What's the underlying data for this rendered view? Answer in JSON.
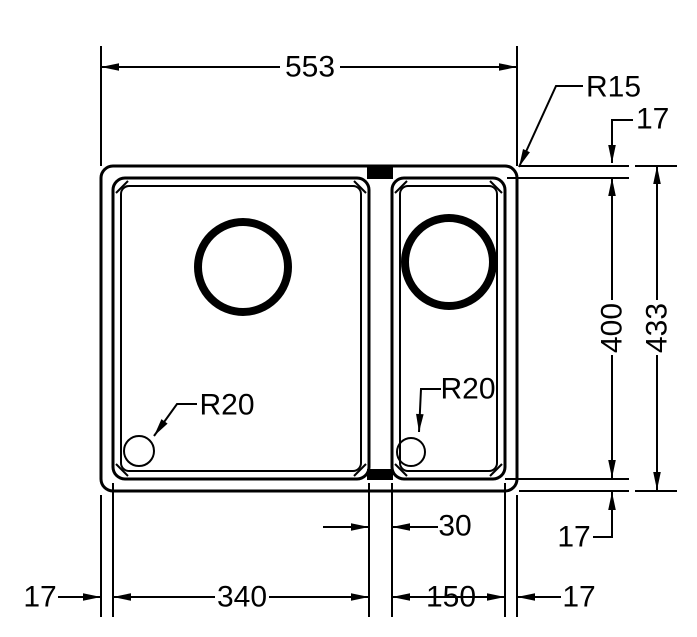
{
  "drawing": {
    "type": "technical-dimension-drawing",
    "subject": "one-and-half-bowl-kitchen-sink-top-view",
    "colors": {
      "line": "#000000",
      "background": "#ffffff"
    },
    "dimensions": {
      "overall_width": "553",
      "overall_depth": "433",
      "bowl_depth": "400",
      "main_bowl_width": "340",
      "half_bowl_width": "150",
      "bowl_gap": "30",
      "rim_top": "17",
      "rim_bottom": "17",
      "rim_left": "17",
      "rim_right": "17"
    },
    "radii": {
      "rim_corner": "R15",
      "main_bowl_corner": "R20",
      "half_bowl_corner": "R20"
    }
  }
}
